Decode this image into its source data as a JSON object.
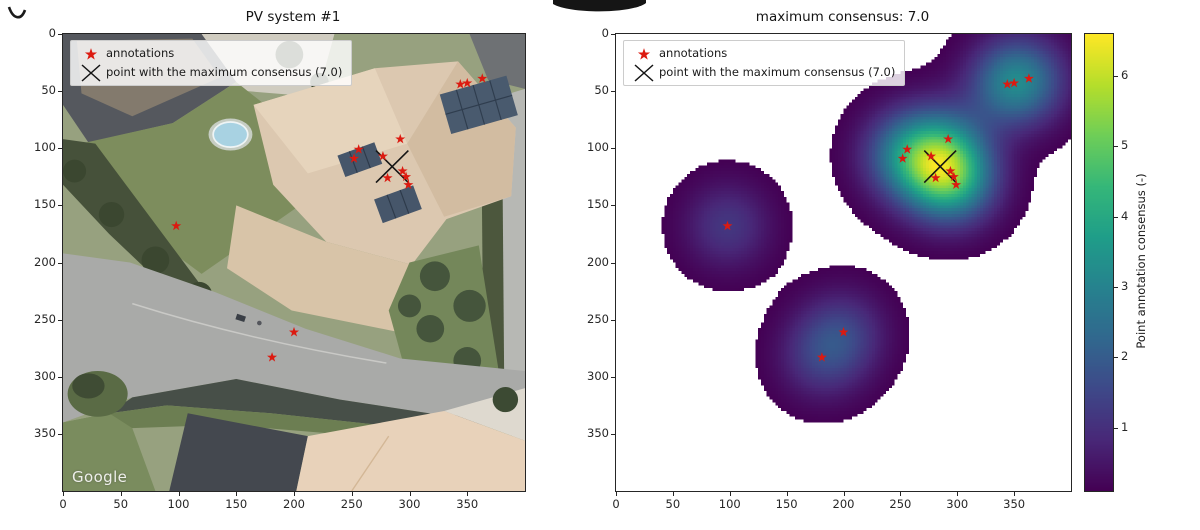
{
  "left_panel": {
    "title": "PV system #1",
    "watermark": "Google",
    "xticks": [
      0,
      50,
      100,
      150,
      200,
      250,
      300,
      350
    ],
    "yticks": [
      0,
      50,
      100,
      150,
      200,
      250,
      300,
      350
    ]
  },
  "right_panel": {
    "title": "maximum consensus: 7.0",
    "xticks": [
      0,
      50,
      100,
      150,
      200,
      250,
      300,
      350
    ],
    "yticks": [
      0,
      50,
      100,
      150,
      200,
      250,
      300,
      350
    ]
  },
  "legend": {
    "annotations_label": "annotations",
    "max_consensus_label": "point with the maximum consensus (7.0)"
  },
  "colorbar": {
    "label": "Point annotation consensus (-)",
    "ticks": [
      1,
      2,
      3,
      4,
      5,
      6
    ],
    "vmin": 0.1,
    "vmax": 6.6,
    "colormap": "viridis"
  },
  "markers": {
    "annotation_color": "#dc1a10",
    "max_point_color": "#151515"
  },
  "chart_data": {
    "type": "heatmap",
    "panels": [
      {
        "name": "left",
        "title": "PV system #1",
        "content": "satellite image with annotation scatter"
      },
      {
        "name": "right",
        "title": "maximum consensus: 7.0",
        "content": "point annotation consensus density map"
      }
    ],
    "xlim": [
      0,
      400
    ],
    "ylim": [
      400,
      0
    ],
    "annotations": [
      [
        292,
        92
      ],
      [
        256,
        101
      ],
      [
        252,
        109
      ],
      [
        277,
        107
      ],
      [
        294,
        120
      ],
      [
        281,
        126
      ],
      [
        297,
        125
      ],
      [
        299,
        132
      ],
      [
        344,
        44
      ],
      [
        350,
        43
      ],
      [
        363,
        39
      ],
      [
        98,
        168
      ],
      [
        200,
        261
      ],
      [
        181,
        283
      ]
    ],
    "max_consensus_point": [
      285,
      116
    ],
    "max_consensus": 7.0,
    "kernel_sigma": 26,
    "mask_below": 0.1,
    "vmax": 6.6,
    "colormap": "viridis",
    "legend_position": "upper left",
    "grid": false
  }
}
